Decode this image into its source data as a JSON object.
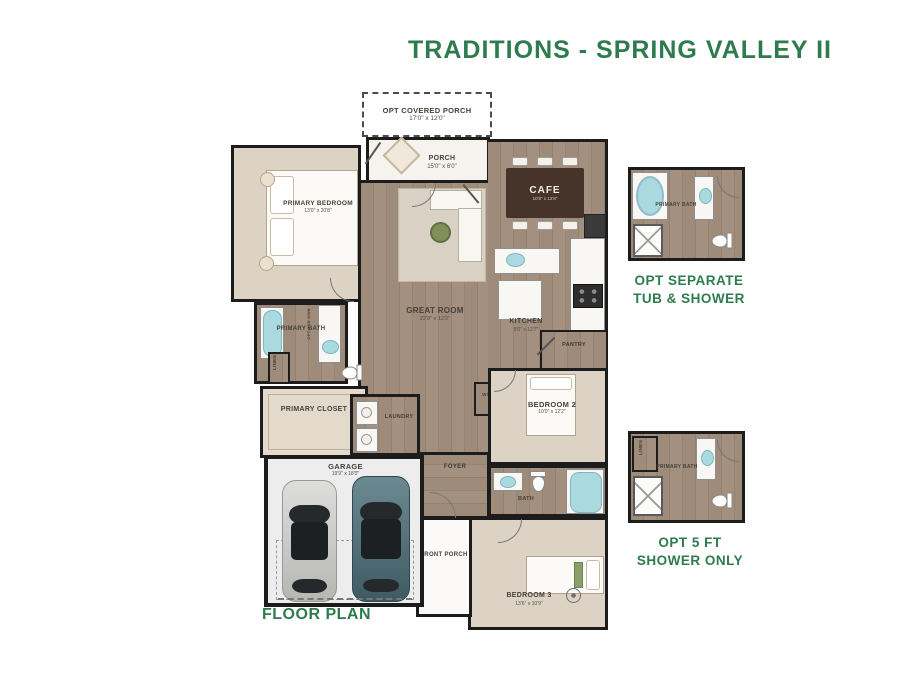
{
  "title": "TRADITIONS - SPRING VALLEY II",
  "plan_label": "FLOOR PLAN",
  "colors": {
    "accent_green": "#2E7B4E",
    "wall": "#1C1C1C",
    "wood_floor": "#9A8776",
    "carpet": "#DDD3C5",
    "water_fixture": "#AAD9E0",
    "garage_floor": "#EDEDED",
    "cafe_table": "#46332A"
  },
  "rooms": {
    "opt_covered_porch": {
      "name": "OPT COVERED PORCH",
      "dims": "17'0\" x 12'0\""
    },
    "porch": {
      "name": "PORCH",
      "dims": "15'0\" x 6'0\""
    },
    "cafe": {
      "name": "CAFE",
      "dims": "10'8\" x 12'8\""
    },
    "primary_bedroom": {
      "name": "PRIMARY BEDROOM",
      "dims": "13'0\" x 20'8\""
    },
    "great_room": {
      "name": "GREAT ROOM",
      "dims": "22'8\" x 12'2\""
    },
    "kitchen": {
      "name": "KITCHEN",
      "dims": "9'0\" x 12'7\""
    },
    "pantry": {
      "name": "PANTRY"
    },
    "primary_bath": {
      "name": "PRIMARY BATH"
    },
    "opt_2nd_sink": {
      "name": "OPT 2ND SINK"
    },
    "linen": {
      "name": "LINEN"
    },
    "primary_closet": {
      "name": "PRIMARY CLOSET"
    },
    "laundry": {
      "name": "LAUNDRY"
    },
    "wd": {
      "name": "W/D"
    },
    "bedroom_2": {
      "name": "BEDROOM 2",
      "dims": "10'0\" x 12'2\""
    },
    "foyer": {
      "name": "FOYER"
    },
    "garage": {
      "name": "GARAGE",
      "dims": "19'9\" x 18'0\""
    },
    "front_porch": {
      "name": "FRONT PORCH"
    },
    "bath": {
      "name": "BATH"
    },
    "bedroom_3": {
      "name": "BEDROOM 3",
      "dims": "13'6\" x 10'9\""
    }
  },
  "options": [
    {
      "caption_line1": "OPT SEPARATE",
      "caption_line2": "TUB & SHOWER",
      "room_label": "PRIMARY BATH"
    },
    {
      "caption_line1": "OPT 5 FT",
      "caption_line2": "SHOWER ONLY",
      "room_label": "PRIMARY BATH",
      "closet_label": "LINEN"
    }
  ]
}
